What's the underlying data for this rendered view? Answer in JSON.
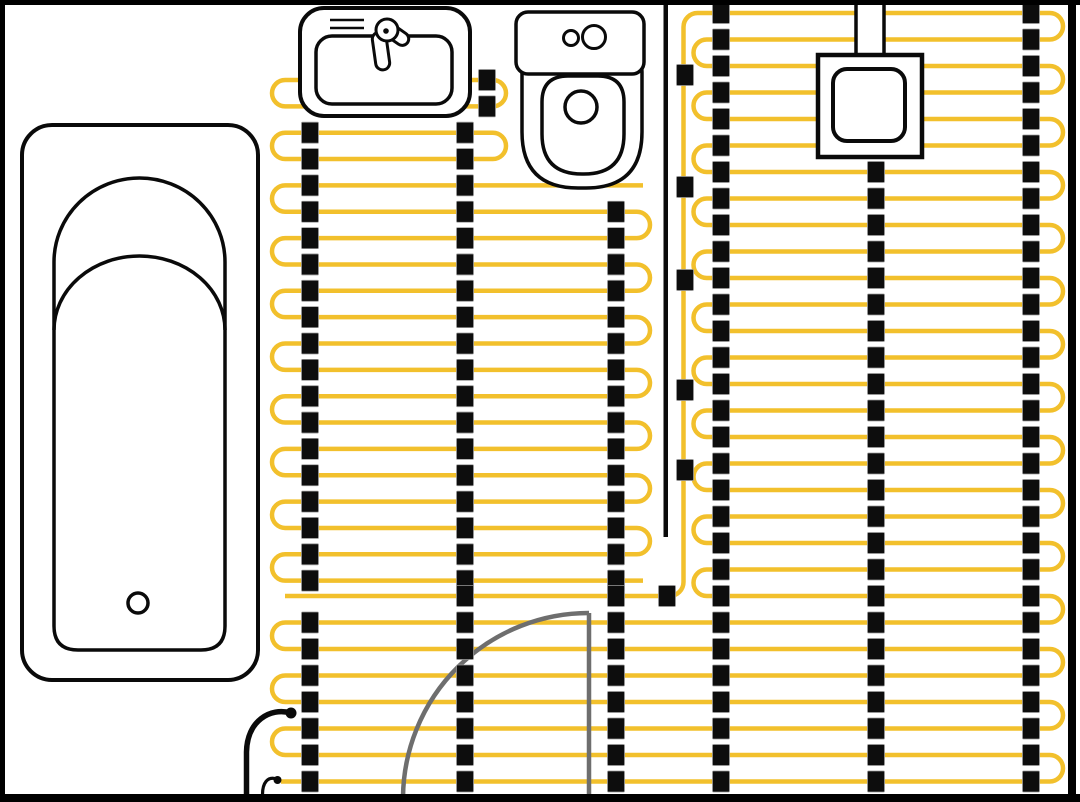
{
  "meta": {
    "width": 1080,
    "height": 802,
    "background": "#FFFFFF",
    "description": "Bathroom floor plan with electric underfloor heating cable layout"
  },
  "colors": {
    "cable": "#F2C02C",
    "clip": "#0D0D0D",
    "clip_edge": "#9A9A9A",
    "fixture": "#0A0A0A",
    "door": "#6E6E6E",
    "frame": "#000000",
    "white": "#FFFFFF"
  },
  "heating": {
    "cable_stroke": 4.5,
    "left_block": {
      "y0": 80,
      "dy": 26.35,
      "count": 20,
      "left_apex": 272,
      "right_apex": 650,
      "top_right_apex": 506,
      "top_stadium_pairs": [
        [
          0,
          1
        ],
        [
          2,
          3
        ]
      ],
      "serpentine_start_row": 4,
      "free_end_x": 643
    },
    "right_block": {
      "y0": 13,
      "dy": 26.5,
      "count": 30,
      "left_apex": 693.5,
      "right_apex": 1063,
      "lower_left_apex": 272,
      "lower_first_left_turn": 23,
      "bottom_end_x": 281
    },
    "feed": {
      "x": 683.5,
      "top_y": 27,
      "curve_r": 14,
      "row_index": 22,
      "row_left_end": 285,
      "clip_x": 685,
      "clip_ys": [
        75,
        187,
        280,
        390,
        470
      ],
      "row_clip_x": 667
    },
    "separator": {
      "x": 663.5,
      "y1": 0,
      "y2": 537,
      "w": 4.5
    },
    "clip": {
      "w": 17,
      "h": 21
    },
    "clip_columns": [
      {
        "x": 487,
        "block": "left",
        "from": 0,
        "to": 1
      },
      {
        "x": 310,
        "block": "left",
        "from": 2,
        "to": 19
      },
      {
        "x": 465,
        "block": "left",
        "from": 2,
        "to": 19
      },
      {
        "x": 616,
        "block": "left",
        "from": 5,
        "to": 19
      },
      {
        "x": 310,
        "block": "right",
        "from": 23,
        "to": 29
      },
      {
        "x": 465,
        "block": "right",
        "from": 22,
        "to": 29
      },
      {
        "x": 616,
        "block": "right",
        "from": 22,
        "to": 29
      },
      {
        "x": 721,
        "block": "right",
        "from": 0,
        "to": 29
      },
      {
        "x": 876,
        "block": "right",
        "from": 6,
        "to": 29
      },
      {
        "x": 1031,
        "block": "right",
        "from": 0,
        "to": 29
      }
    ]
  },
  "fixtures": {
    "bathtub": {
      "outer": {
        "x": 22,
        "y": 125,
        "w": 236,
        "h": 555,
        "r": 30,
        "stroke": 4
      },
      "inner": {
        "left": 54,
        "right": 225,
        "spring_y": 262,
        "arc_ry": 84,
        "bottom": 650,
        "bottom_r": 24,
        "stroke": 3.5
      },
      "contour_arc": {
        "spring_y": 330,
        "ry": 74
      },
      "drain": {
        "cx": 138,
        "cy": 603,
        "r": 10,
        "stroke": 3.5
      }
    },
    "sink": {
      "outer": {
        "x": 300,
        "y": 8,
        "w": 170,
        "h": 108,
        "r": 24,
        "stroke": 4
      },
      "basin": {
        "x": 316,
        "y": 36,
        "w": 136,
        "h": 68,
        "r": 16,
        "stroke": 3.5
      },
      "detail_lines": [
        [
          330,
          20,
          364,
          20
        ],
        [
          330,
          28,
          364,
          28
        ]
      ],
      "faucet": {
        "handle": {
          "x": 384,
          "y": 23,
          "w": 28,
          "h": 13,
          "r": 6.5,
          "rot": 35,
          "cx": 389,
          "cy": 29
        },
        "spout": {
          "x": 374,
          "y": 32,
          "w": 14,
          "h": 38,
          "r": 7,
          "rot": -8,
          "cx": 381,
          "cy": 51
        },
        "pivot": {
          "cx": 387,
          "cy": 30,
          "r": 11
        },
        "dot_r": 2.8,
        "stroke": 3
      }
    },
    "toilet": {
      "tank": {
        "x": 516,
        "y": 12,
        "w": 128,
        "h": 62,
        "r": 12,
        "stroke": 3.5
      },
      "buttons": [
        {
          "cx": 571,
          "cy": 38,
          "r": 7.5
        },
        {
          "cx": 594,
          "cy": 37,
          "r": 11.5
        }
      ],
      "bowl": {
        "x": 522,
        "y": 56,
        "w": 120,
        "h": 132,
        "r_top": 16,
        "r_bottom": 56,
        "stroke": 3.5
      },
      "seat": {
        "x": 542,
        "y": 76,
        "w": 82,
        "h": 98,
        "r_top": 26,
        "r_bottom": 40,
        "stroke": 3.5
      },
      "hole": {
        "cx": 581,
        "cy": 107,
        "r": 16,
        "stroke": 3.5
      }
    },
    "thermostat": {
      "conduit": {
        "x": 856,
        "y": -5,
        "w": 28,
        "h": 63,
        "stroke": 3.5
      },
      "box": {
        "x": 818,
        "y": 55,
        "w": 104,
        "h": 102,
        "stroke": 4.5
      },
      "inner": {
        "x": 833,
        "y": 69,
        "w": 72,
        "h": 72,
        "r": 14,
        "stroke": 4
      }
    },
    "door": {
      "leaf": {
        "x": 589,
        "y1": 613,
        "y2": 797
      },
      "arc": {
        "from_x": 403,
        "floor_y": 797,
        "r": 186
      },
      "stroke": 4.5
    },
    "power_lead": {
      "path": "M 291 713 C 270 707 247 721 246.5 752 L 246.5 794",
      "stroke": 5.5,
      "dot": {
        "cx": 291,
        "cy": 713,
        "r": 5.5
      }
    },
    "sensor_lead": {
      "path": "M 262.5 794.5 C 262.5 783 267.5 776 276.5 779",
      "stroke": 3.2,
      "dot": {
        "cx": 277.5,
        "cy": 780,
        "r": 4
      }
    }
  },
  "frame": {
    "top_h": 5,
    "left_w": 5,
    "right_x": 1068,
    "right_w": 8,
    "bottom_y": 794,
    "bottom_h": 8
  }
}
